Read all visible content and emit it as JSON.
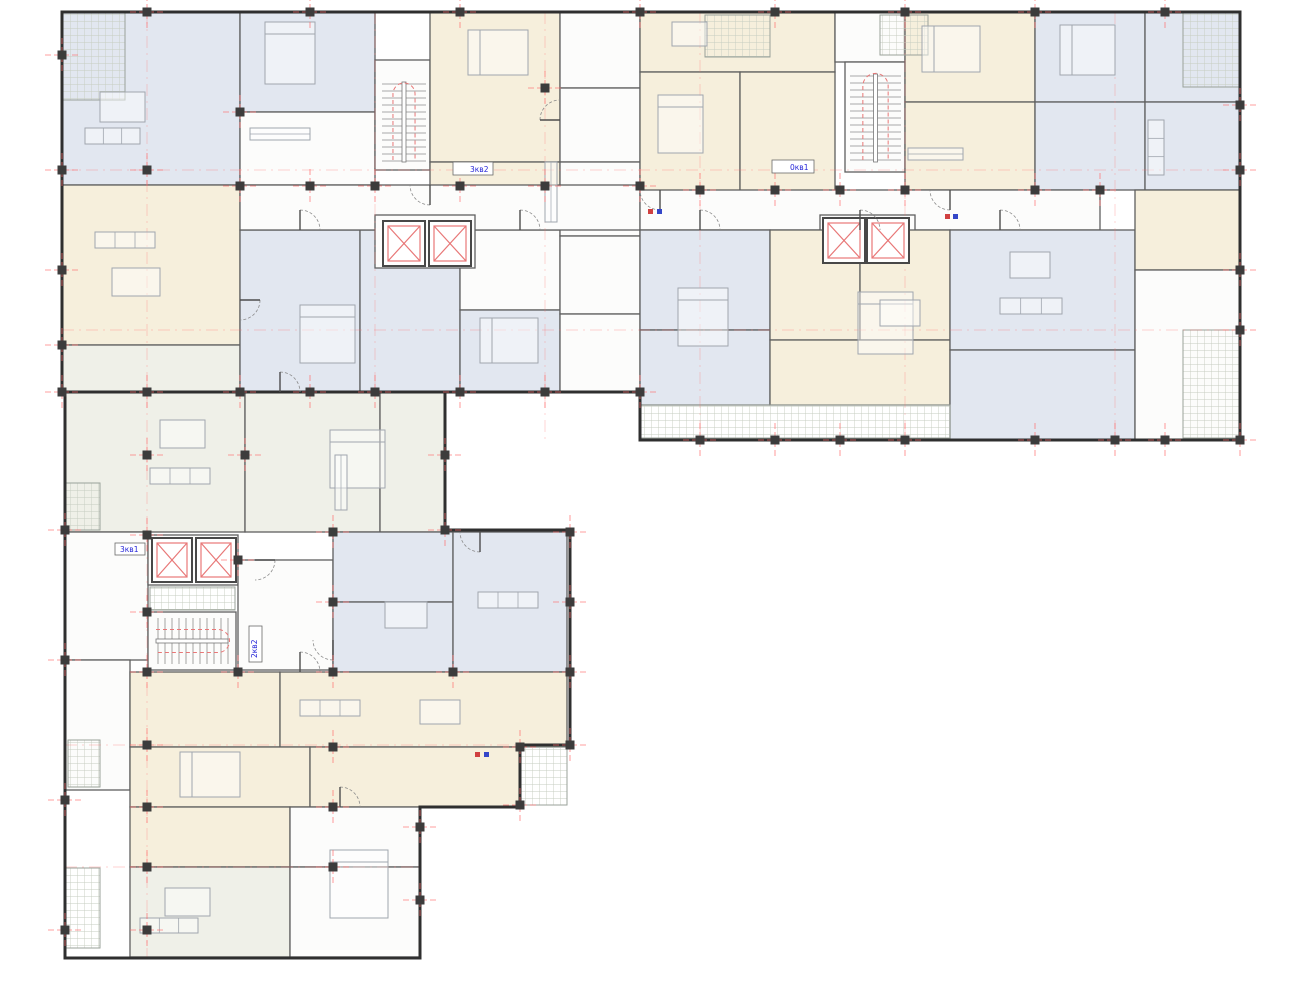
{
  "title": "Residential building floor plan",
  "palette": {
    "background": "#ffffff",
    "outer_wall": "#2f2f2f",
    "partition": "#5f5f5f",
    "tread": "#8d8d8d",
    "furniture": "#a0a6ae",
    "hatch": "#c6ccc0",
    "hatch_border": "#9aa29a",
    "red": "#e87777",
    "axis_red": "#ff6b6b",
    "column": "#3c3c3c",
    "label_blue": "#2626d8",
    "riser_red": "#d04040",
    "riser_blue": "#3446c8"
  },
  "plan": {
    "tones": {
      "blue": "#e2e7f0",
      "cream": "#f6efdc",
      "pale": "#eff0e8",
      "white": "#fcfcfb"
    },
    "outlines": [
      "M62 12 H1240 V440 H640 V392 H62 Z",
      "M65 392 V958 H420 V807 H520 V745 H570 V530 H445 V392 Z"
    ],
    "rooms": [
      [
        62,
        12,
        178,
        173,
        "blue"
      ],
      [
        240,
        12,
        135,
        100,
        "blue"
      ],
      [
        240,
        112,
        135,
        73,
        "white"
      ],
      [
        375,
        60,
        55,
        110,
        "white"
      ],
      [
        430,
        12,
        130,
        150,
        "cream"
      ],
      [
        430,
        162,
        130,
        62,
        "cream"
      ],
      [
        560,
        12,
        80,
        76,
        "white"
      ],
      [
        560,
        88,
        80,
        74,
        "white"
      ],
      [
        62,
        185,
        178,
        160,
        "cream"
      ],
      [
        62,
        345,
        178,
        47,
        "pale"
      ],
      [
        240,
        230,
        120,
        162,
        "blue"
      ],
      [
        360,
        230,
        100,
        162,
        "blue"
      ],
      [
        460,
        230,
        100,
        80,
        "white"
      ],
      [
        460,
        310,
        100,
        82,
        "blue"
      ],
      [
        560,
        162,
        80,
        74,
        "white"
      ],
      [
        560,
        236,
        80,
        78,
        "white"
      ],
      [
        560,
        314,
        80,
        78,
        "white"
      ],
      [
        640,
        12,
        195,
        60,
        "cream"
      ],
      [
        640,
        72,
        100,
        158,
        "cream"
      ],
      [
        740,
        72,
        95,
        158,
        "cream"
      ],
      [
        835,
        12,
        70,
        50,
        "white"
      ],
      [
        845,
        62,
        60,
        110,
        "white"
      ],
      [
        905,
        12,
        130,
        90,
        "cream"
      ],
      [
        905,
        102,
        130,
        88,
        "cream"
      ],
      [
        1035,
        12,
        110,
        90,
        "blue"
      ],
      [
        1145,
        12,
        95,
        90,
        "blue"
      ],
      [
        1035,
        102,
        110,
        88,
        "blue"
      ],
      [
        1145,
        102,
        95,
        88,
        "blue"
      ],
      [
        240,
        185,
        400,
        45,
        "white"
      ],
      [
        640,
        190,
        460,
        40,
        "white"
      ],
      [
        375,
        215,
        100,
        53,
        "white"
      ],
      [
        820,
        215,
        95,
        53,
        "white"
      ],
      [
        640,
        230,
        130,
        100,
        "blue"
      ],
      [
        640,
        330,
        130,
        75,
        "blue"
      ],
      [
        770,
        230,
        90,
        110,
        "cream"
      ],
      [
        860,
        230,
        90,
        110,
        "cream"
      ],
      [
        770,
        340,
        180,
        65,
        "cream"
      ],
      [
        950,
        230,
        185,
        120,
        "blue"
      ],
      [
        950,
        350,
        185,
        90,
        "blue"
      ],
      [
        1135,
        190,
        105,
        80,
        "cream"
      ],
      [
        1135,
        270,
        105,
        170,
        "white"
      ],
      [
        65,
        392,
        180,
        140,
        "pale"
      ],
      [
        245,
        392,
        135,
        140,
        "pale"
      ],
      [
        380,
        392,
        65,
        140,
        "pale"
      ],
      [
        65,
        532,
        83,
        128,
        "white"
      ],
      [
        148,
        535,
        90,
        50,
        "white"
      ],
      [
        148,
        612,
        88,
        58,
        "white"
      ],
      [
        238,
        560,
        95,
        110,
        "white"
      ],
      [
        333,
        532,
        120,
        70,
        "blue"
      ],
      [
        333,
        602,
        120,
        70,
        "blue"
      ],
      [
        453,
        532,
        114,
        140,
        "blue"
      ],
      [
        65,
        660,
        65,
        130,
        "white"
      ],
      [
        130,
        672,
        150,
        75,
        "cream"
      ],
      [
        280,
        672,
        287,
        75,
        "cream"
      ],
      [
        130,
        747,
        180,
        60,
        "cream"
      ],
      [
        310,
        747,
        210,
        60,
        "cream"
      ],
      [
        130,
        807,
        160,
        60,
        "cream"
      ],
      [
        290,
        807,
        130,
        60,
        "white"
      ],
      [
        130,
        867,
        160,
        90,
        "pale"
      ],
      [
        290,
        867,
        130,
        90,
        "white"
      ]
    ],
    "balconies": [
      [
        62,
        12,
        63,
        88
      ],
      [
        705,
        15,
        65,
        42
      ],
      [
        880,
        15,
        48,
        40
      ],
      [
        1183,
        12,
        57,
        75
      ],
      [
        1183,
        330,
        57,
        108
      ],
      [
        640,
        405,
        310,
        33
      ],
      [
        150,
        587,
        85,
        23
      ],
      [
        65,
        483,
        35,
        47
      ],
      [
        68,
        740,
        32,
        47
      ],
      [
        66,
        868,
        34,
        80
      ],
      [
        520,
        747,
        47,
        58
      ]
    ],
    "axes": {
      "v": [
        [
          147,
          12,
          958
        ],
        [
          375,
          12,
          392
        ],
        [
          545,
          12,
          440
        ],
        [
          700,
          12,
          440
        ],
        [
          905,
          12,
          440
        ],
        [
          1115,
          12,
          440
        ]
      ],
      "h": [
        [
          170,
          62,
          1240
        ],
        [
          330,
          62,
          1240
        ],
        [
          745,
          65,
          570
        ],
        [
          867,
          65,
          420
        ]
      ]
    },
    "stairs": [
      {
        "x": 380,
        "y": 78,
        "w": 48,
        "h": 88,
        "o": "v"
      },
      {
        "x": 848,
        "y": 70,
        "w": 55,
        "h": 96,
        "o": "v"
      },
      {
        "x": 152,
        "y": 616,
        "w": 80,
        "h": 50,
        "o": "h"
      }
    ],
    "elevators": [
      [
        383,
        221,
        42,
        45
      ],
      [
        429,
        221,
        42,
        45
      ],
      [
        823,
        218,
        42,
        45
      ],
      [
        867,
        218,
        42,
        45
      ],
      [
        152,
        538,
        40,
        44
      ],
      [
        196,
        538,
        40,
        44
      ]
    ],
    "doors": [
      [
        300,
        230,
        0
      ],
      [
        520,
        230,
        0
      ],
      [
        430,
        185,
        180
      ],
      [
        700,
        230,
        0
      ],
      [
        860,
        230,
        0
      ],
      [
        1000,
        230,
        0
      ],
      [
        280,
        392,
        0
      ],
      [
        255,
        560,
        90
      ],
      [
        333,
        640,
        180
      ],
      [
        300,
        672,
        0
      ],
      [
        340,
        807,
        0
      ],
      [
        480,
        532,
        180
      ],
      [
        660,
        190,
        180
      ],
      [
        950,
        190,
        180
      ],
      [
        240,
        300,
        90
      ],
      [
        560,
        120,
        270
      ]
    ],
    "furniture": [
      {
        "t": "bed",
        "r": [
          265,
          22,
          50,
          62
        ]
      },
      {
        "t": "bed",
        "r": [
          468,
          30,
          60,
          45
        ]
      },
      {
        "t": "bed",
        "r": [
          658,
          95,
          45,
          58
        ]
      },
      {
        "t": "bed",
        "r": [
          922,
          26,
          58,
          46
        ]
      },
      {
        "t": "bed",
        "r": [
          300,
          305,
          55,
          58
        ]
      },
      {
        "t": "bed",
        "r": [
          480,
          318,
          58,
          45
        ]
      },
      {
        "t": "bed",
        "r": [
          678,
          288,
          50,
          58
        ]
      },
      {
        "t": "bed",
        "r": [
          858,
          292,
          55,
          62
        ]
      },
      {
        "t": "bed",
        "r": [
          330,
          430,
          55,
          58
        ]
      },
      {
        "t": "bed",
        "r": [
          180,
          752,
          60,
          45
        ]
      },
      {
        "t": "bed",
        "r": [
          330,
          850,
          58,
          68
        ]
      },
      {
        "t": "bed",
        "r": [
          1060,
          25,
          55,
          50
        ]
      },
      {
        "t": "sofa",
        "r": [
          85,
          128,
          55,
          16
        ]
      },
      {
        "t": "sofa",
        "r": [
          95,
          232,
          60,
          16
        ]
      },
      {
        "t": "sofa",
        "r": [
          1000,
          298,
          62,
          16
        ]
      },
      {
        "t": "sofa",
        "r": [
          150,
          468,
          60,
          16
        ]
      },
      {
        "t": "sofa",
        "r": [
          478,
          592,
          60,
          16
        ]
      },
      {
        "t": "sofa",
        "r": [
          300,
          700,
          60,
          16
        ]
      },
      {
        "t": "sofa",
        "r": [
          140,
          918,
          58,
          15
        ]
      },
      {
        "t": "sofa",
        "r": [
          1148,
          120,
          16,
          55
        ]
      },
      {
        "t": "table",
        "r": [
          100,
          92,
          45,
          30
        ]
      },
      {
        "t": "table",
        "r": [
          112,
          268,
          48,
          28
        ]
      },
      {
        "t": "table",
        "r": [
          672,
          22,
          35,
          24
        ]
      },
      {
        "t": "table",
        "r": [
          1010,
          252,
          40,
          26
        ]
      },
      {
        "t": "table",
        "r": [
          160,
          420,
          45,
          28
        ]
      },
      {
        "t": "table",
        "r": [
          385,
          602,
          42,
          26
        ]
      },
      {
        "t": "table",
        "r": [
          420,
          700,
          40,
          24
        ]
      },
      {
        "t": "table",
        "r": [
          165,
          888,
          45,
          28
        ]
      },
      {
        "t": "table",
        "r": [
          880,
          300,
          40,
          26
        ]
      },
      {
        "t": "counter",
        "r": [
          250,
          128,
          60,
          12
        ]
      },
      {
        "t": "counter",
        "r": [
          908,
          148,
          55,
          12
        ]
      },
      {
        "t": "counter",
        "r": [
          335,
          455,
          12,
          55
        ]
      },
      {
        "t": "counter",
        "r": [
          545,
          162,
          12,
          60
        ]
      }
    ],
    "columns": [
      [
        147,
        12
      ],
      [
        310,
        12
      ],
      [
        460,
        12
      ],
      [
        640,
        12
      ],
      [
        775,
        12
      ],
      [
        905,
        12
      ],
      [
        1035,
        12
      ],
      [
        1165,
        12
      ],
      [
        62,
        55
      ],
      [
        62,
        170
      ],
      [
        62,
        270
      ],
      [
        62,
        345
      ],
      [
        240,
        186
      ],
      [
        310,
        186
      ],
      [
        375,
        186
      ],
      [
        460,
        186
      ],
      [
        545,
        186
      ],
      [
        640,
        186
      ],
      [
        700,
        190
      ],
      [
        775,
        190
      ],
      [
        840,
        190
      ],
      [
        905,
        190
      ],
      [
        1035,
        190
      ],
      [
        1100,
        190
      ],
      [
        147,
        170
      ],
      [
        240,
        112
      ],
      [
        545,
        88
      ],
      [
        62,
        392
      ],
      [
        147,
        392
      ],
      [
        240,
        392
      ],
      [
        310,
        392
      ],
      [
        375,
        392
      ],
      [
        460,
        392
      ],
      [
        545,
        392
      ],
      [
        640,
        392
      ],
      [
        700,
        440
      ],
      [
        775,
        440
      ],
      [
        840,
        440
      ],
      [
        905,
        440
      ],
      [
        1035,
        440
      ],
      [
        1115,
        440
      ],
      [
        1165,
        440
      ],
      [
        1240,
        440
      ],
      [
        1240,
        105
      ],
      [
        1240,
        170
      ],
      [
        1240,
        270
      ],
      [
        1240,
        330
      ],
      [
        65,
        530
      ],
      [
        65,
        660
      ],
      [
        65,
        800
      ],
      [
        65,
        930
      ],
      [
        147,
        455
      ],
      [
        147,
        535
      ],
      [
        147,
        612
      ],
      [
        147,
        672
      ],
      [
        147,
        745
      ],
      [
        147,
        807
      ],
      [
        147,
        867
      ],
      [
        147,
        930
      ],
      [
        245,
        455
      ],
      [
        238,
        560
      ],
      [
        238,
        672
      ],
      [
        333,
        532
      ],
      [
        333,
        602
      ],
      [
        333,
        672
      ],
      [
        333,
        747
      ],
      [
        333,
        807
      ],
      [
        333,
        867
      ],
      [
        420,
        827
      ],
      [
        420,
        900
      ],
      [
        445,
        455
      ],
      [
        445,
        530
      ],
      [
        453,
        672
      ],
      [
        570,
        532
      ],
      [
        570,
        602
      ],
      [
        570,
        672
      ],
      [
        570,
        745
      ],
      [
        520,
        747
      ],
      [
        520,
        805
      ]
    ],
    "risers": [
      [
        648,
        209,
        "r"
      ],
      [
        657,
        209,
        "b"
      ],
      [
        945,
        214,
        "r"
      ],
      [
        953,
        214,
        "b"
      ],
      [
        475,
        752,
        "r"
      ],
      [
        484,
        752,
        "b"
      ]
    ],
    "labels": [
      {
        "x": 470,
        "y": 172,
        "t": "3кв2",
        "rot": 0,
        "bx": [
          453,
          162,
          40,
          13
        ]
      },
      {
        "x": 790,
        "y": 170,
        "t": "0кв1",
        "rot": 0,
        "bx": [
          772,
          160,
          42,
          13
        ]
      },
      {
        "x": 120,
        "y": 552,
        "t": "3кв1",
        "rot": 0,
        "bx": [
          115,
          543,
          30,
          12
        ]
      },
      {
        "x": 257,
        "y": 658,
        "t": "2кв2",
        "rot": -90,
        "bx": [
          249,
          626,
          13,
          36
        ]
      }
    ]
  }
}
